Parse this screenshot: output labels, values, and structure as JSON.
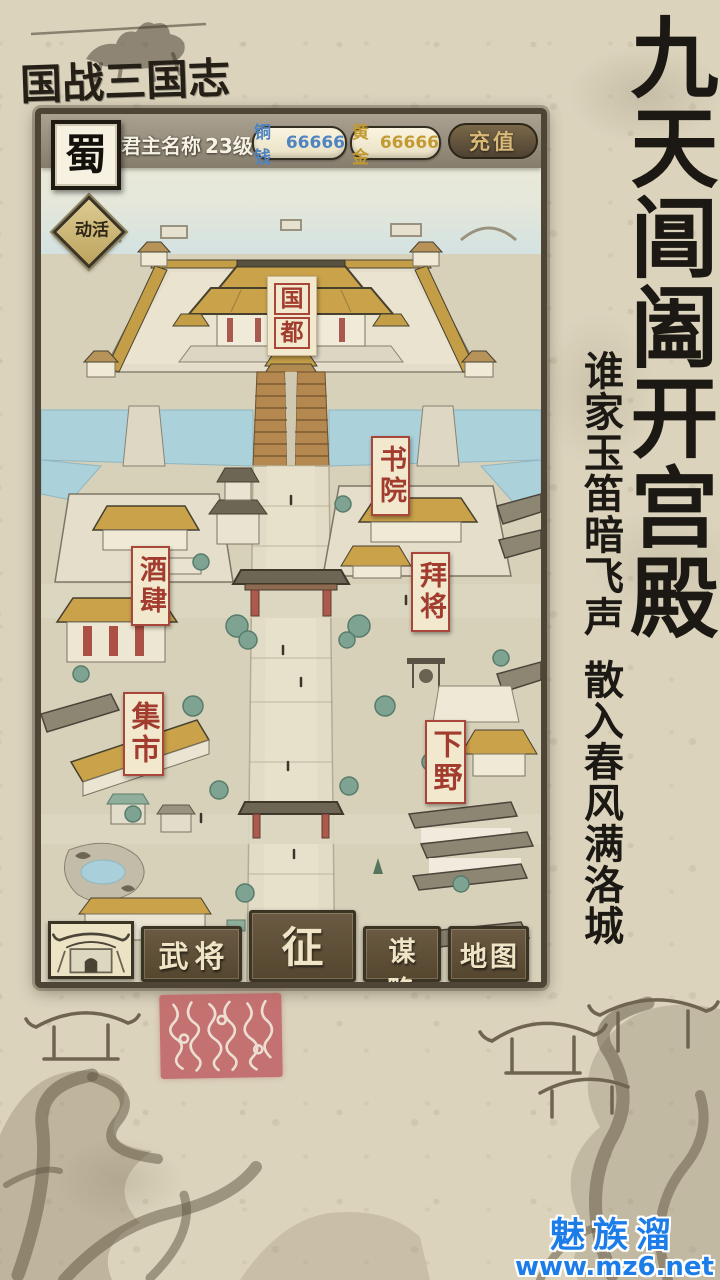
{
  "page": {
    "logo_title": "国战三国志",
    "headline": "九天阊阖开宫殿",
    "poem_line1": "谁家玉笛暗飞声",
    "poem_line2": "散入春风满洛城",
    "watermark_name": "魅族溜",
    "watermark_url": "www.mz6.net"
  },
  "game": {
    "hud": {
      "faction": "蜀",
      "lord_name": "君主名称",
      "level": "23级",
      "currencies": [
        {
          "name": "铜钱",
          "value": "66666",
          "color": "#4f84c0"
        },
        {
          "name": "黄金",
          "value": "66666",
          "color": "#c19a32"
        }
      ],
      "recharge_label": "充值"
    },
    "map_labels": {
      "event": "活动",
      "capital_chars": [
        "国",
        "都"
      ],
      "academy": "书院",
      "tavern": "酒肆",
      "appoint_general": "拜将",
      "market": "集市",
      "resign": "下野"
    },
    "nav": [
      {
        "id": "generals",
        "label": "武将",
        "featured": false
      },
      {
        "id": "campaign",
        "label": "征战",
        "featured": true
      },
      {
        "id": "strategy",
        "label": "谋略",
        "featured": false
      },
      {
        "id": "map",
        "label": "地图",
        "featured": false
      }
    ],
    "colors": {
      "label_red": "#a23c2e",
      "roof_gold": "#c9a24a",
      "nav_brown": "#5d4e3a",
      "water_blue": "#abd1db",
      "watermark_blue": "#1d7de8",
      "seal_red": "#c16668"
    }
  }
}
